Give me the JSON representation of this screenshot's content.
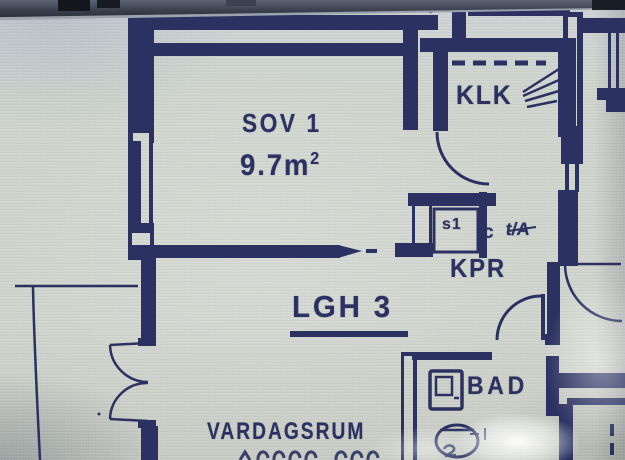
{
  "photo": {
    "description_label": "floor-plan-photo",
    "top_bezel_bar": true
  },
  "plan": {
    "apartment_label": "LGH 3",
    "vent_label": "V",
    "rooms": {
      "sov1": {
        "name": "SOV 1",
        "area_value": "9.7m",
        "area_sup": "2"
      },
      "klk": {
        "name": "KLK"
      },
      "kpr": {
        "name": "KPR"
      },
      "bad": {
        "name": "BAD"
      },
      "vardagsrum": {
        "name": "VARDAGSRUM"
      }
    },
    "fixture_labels": {
      "s1": "s1",
      "c": "c",
      "ta": "t/A"
    },
    "colors": {
      "ink": "#2b3161",
      "paper": "#ced3cc"
    }
  }
}
